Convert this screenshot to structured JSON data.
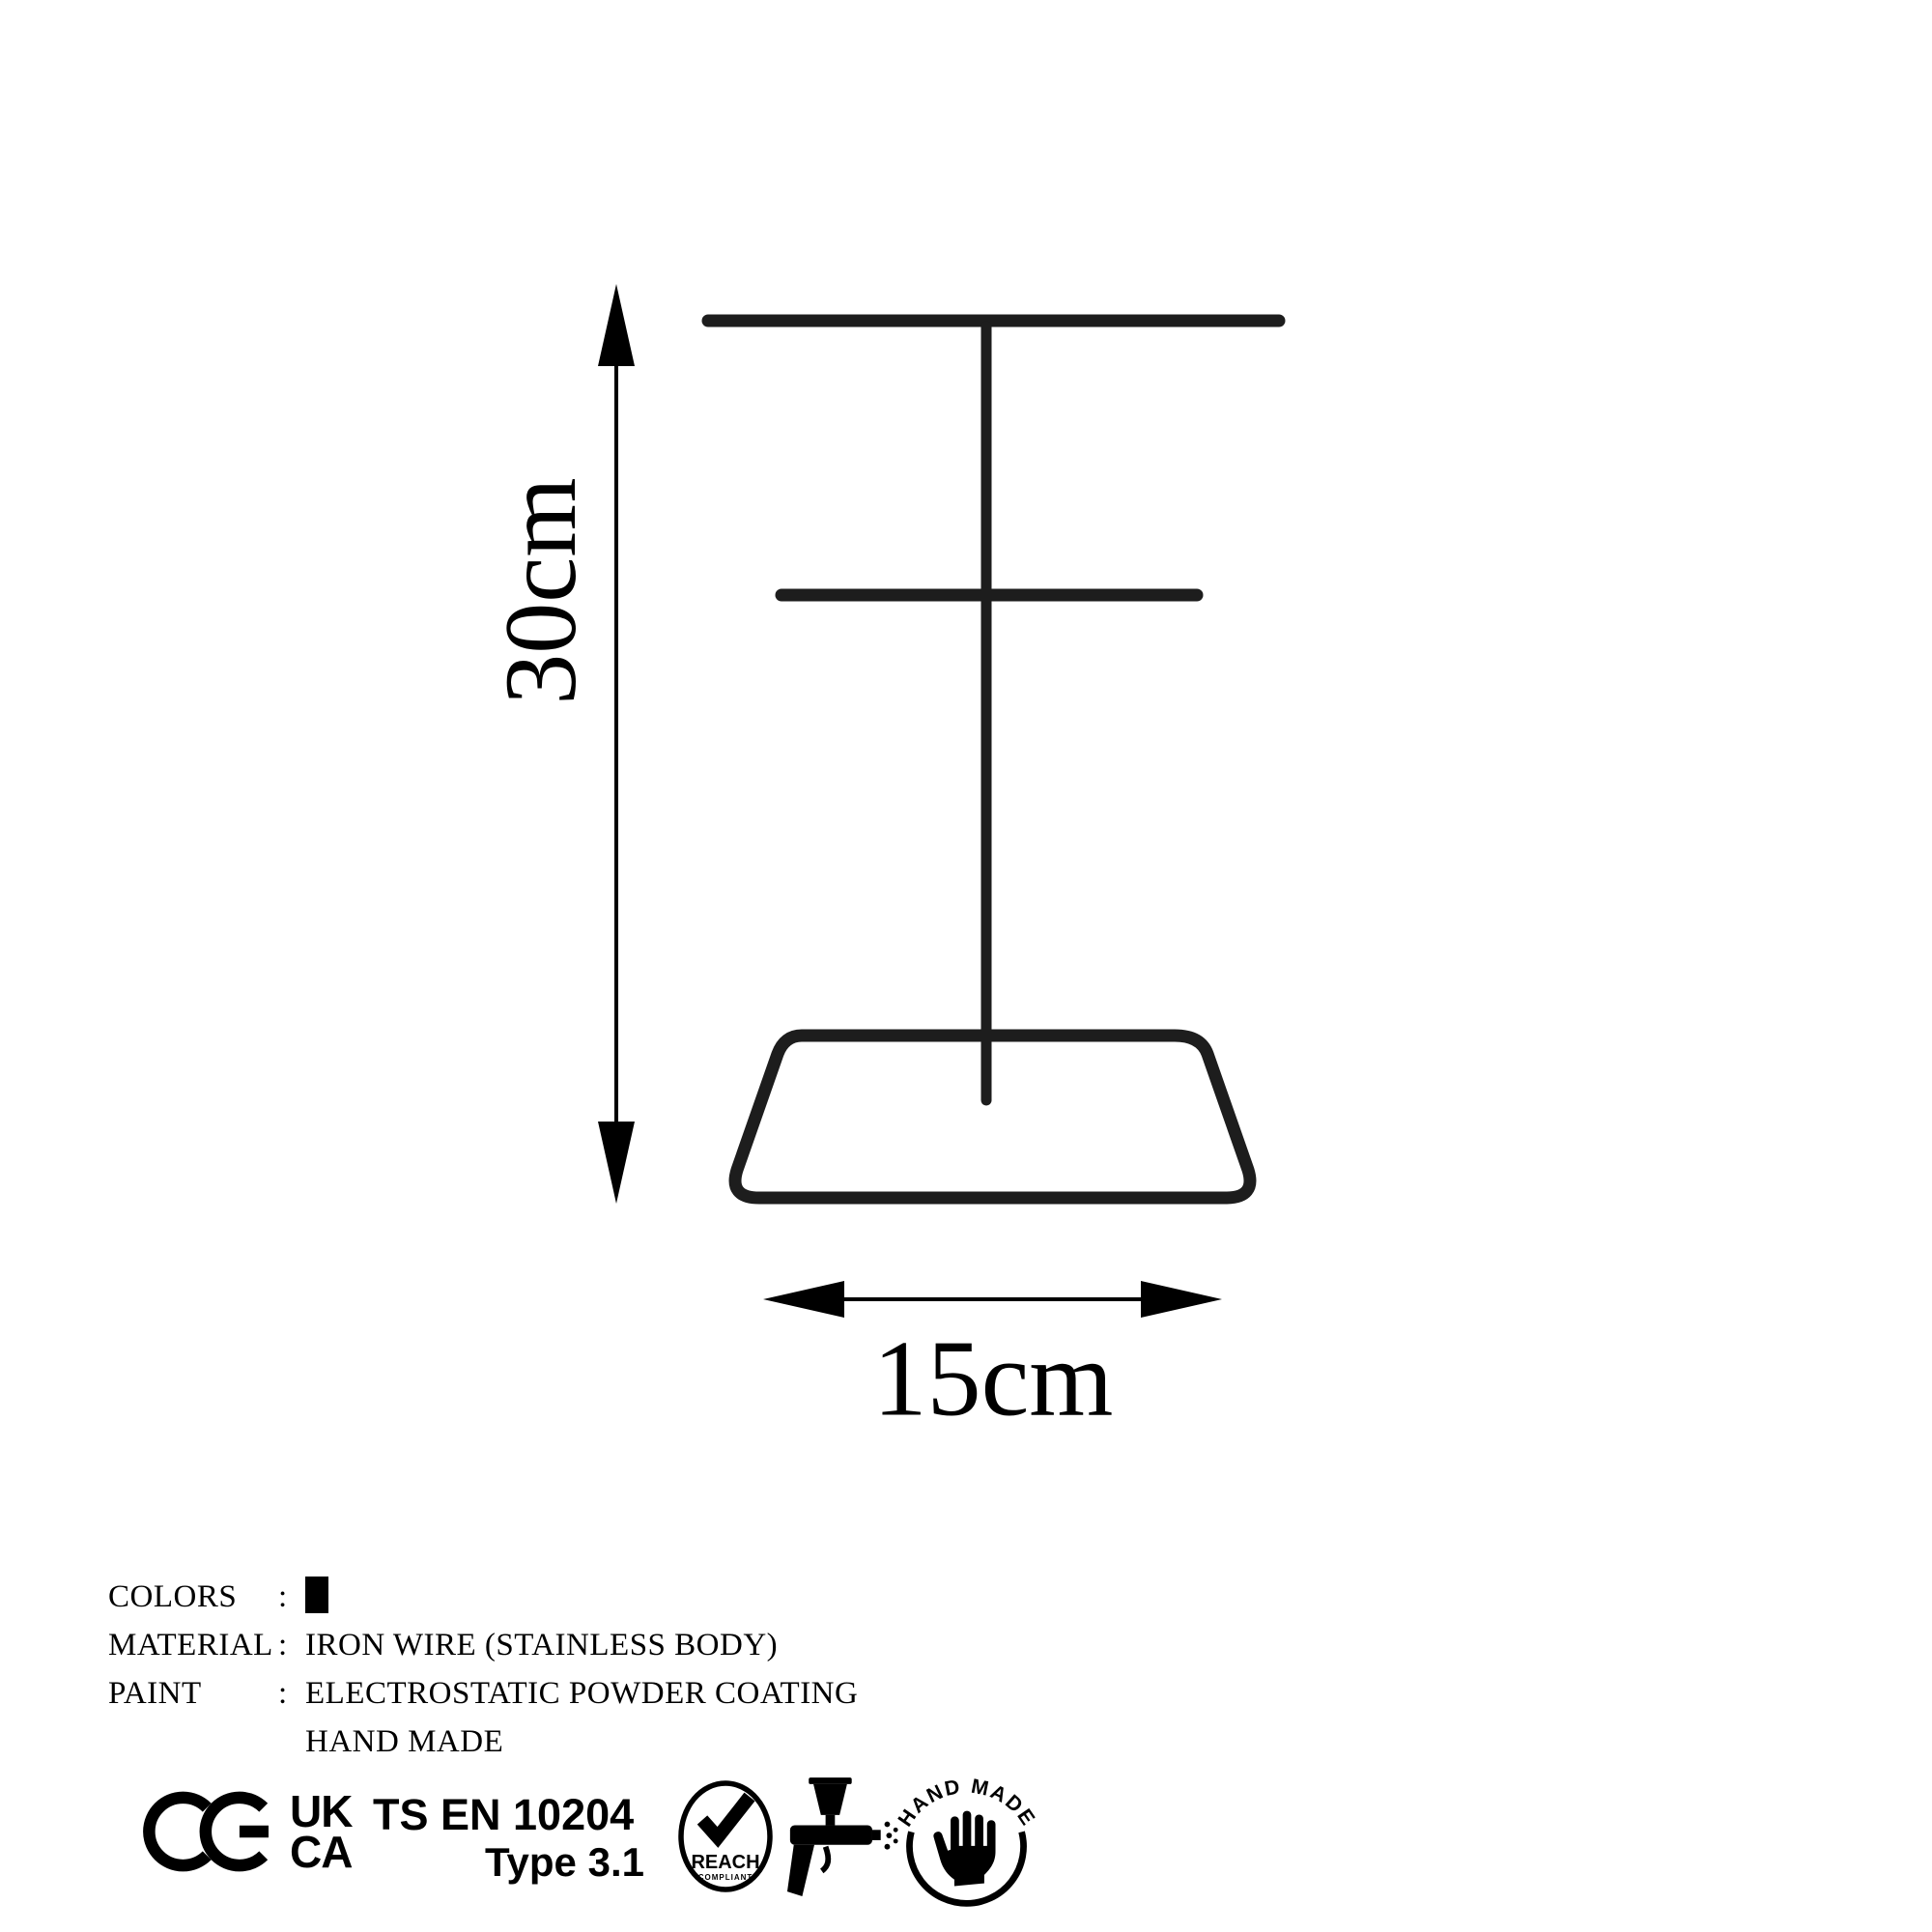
{
  "dimensions": {
    "height_label": "30cm",
    "width_label": "15cm"
  },
  "specs": {
    "rows": [
      {
        "label": "COLORS",
        "separator": ":",
        "value": "",
        "swatch_color": "#000000"
      },
      {
        "label": "MATERIAL",
        "separator": ":",
        "value": "IRON WIRE (STAINLESS BODY)"
      },
      {
        "label": "PAINT",
        "separator": ":",
        "value": "ELECTROSTATIC POWDER COATING"
      },
      {
        "label": "",
        "separator": "",
        "value": "HAND MADE"
      }
    ]
  },
  "certifications": {
    "ce_mark": "CE",
    "ukca": {
      "line1": "UK",
      "line2": "CA"
    },
    "standard": {
      "line1": "TS EN 10204",
      "line2": "Type 3.1"
    },
    "reach": {
      "label": "REACH",
      "sublabel": "COMPLIANT"
    },
    "handmade": {
      "arc_text": "HAND MADE"
    }
  },
  "colors": {
    "background": "#ffffff",
    "ink": "#000000",
    "wire": "#1d1d1d"
  }
}
